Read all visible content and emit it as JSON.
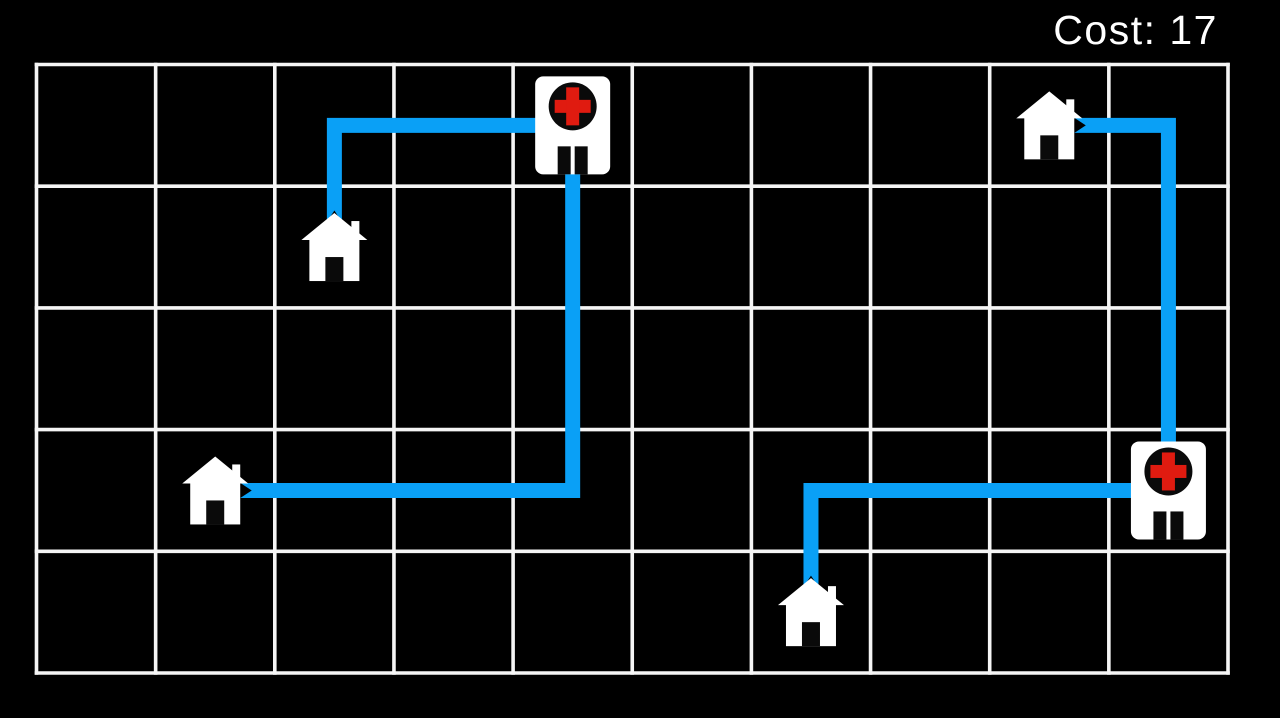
{
  "hud": {
    "cost_label": "Cost: 17",
    "cost_value": 17
  },
  "colors": {
    "background": "#000000",
    "grid_line": "#f5f5f5",
    "path": "#0aa0f6",
    "building_fill": "#ffffff",
    "hospital_circle": "#0a0a0a",
    "hospital_cross": "#e01b10",
    "door": "#0a0a0a",
    "hud_text": "#ffffff"
  },
  "board": {
    "cols": 10,
    "rows": 5,
    "objects": [
      {
        "id": "hospital-1",
        "type": "hospital",
        "icon": "hospital-icon",
        "col": 4,
        "row": 0
      },
      {
        "id": "hospital-2",
        "type": "hospital",
        "icon": "hospital-icon",
        "col": 9,
        "row": 3
      },
      {
        "id": "house-1",
        "type": "house",
        "icon": "house-icon",
        "col": 2,
        "row": 1
      },
      {
        "id": "house-2",
        "type": "house",
        "icon": "house-icon",
        "col": 1,
        "row": 3
      },
      {
        "id": "house-3",
        "type": "house",
        "icon": "house-icon",
        "col": 8,
        "row": 0
      },
      {
        "id": "house-4",
        "type": "house",
        "icon": "house-icon",
        "col": 6,
        "row": 4
      }
    ],
    "paths": [
      {
        "from": "house-1",
        "to": "hospital-1",
        "route_cells": [
          [
            2,
            1
          ],
          [
            2,
            0
          ],
          [
            4,
            0
          ]
        ],
        "length_cells": 3
      },
      {
        "from": "house-2",
        "to": "hospital-1",
        "route_cells": [
          [
            1,
            3
          ],
          [
            4,
            3
          ],
          [
            4,
            0
          ]
        ],
        "length_cells": 6
      },
      {
        "from": "house-3",
        "to": "hospital-2",
        "route_cells": [
          [
            8,
            0
          ],
          [
            9,
            0
          ],
          [
            9,
            3
          ]
        ],
        "length_cells": 4
      },
      {
        "from": "house-4",
        "to": "hospital-2",
        "route_cells": [
          [
            6,
            4
          ],
          [
            6,
            3
          ],
          [
            9,
            3
          ]
        ],
        "length_cells": 4
      }
    ]
  }
}
